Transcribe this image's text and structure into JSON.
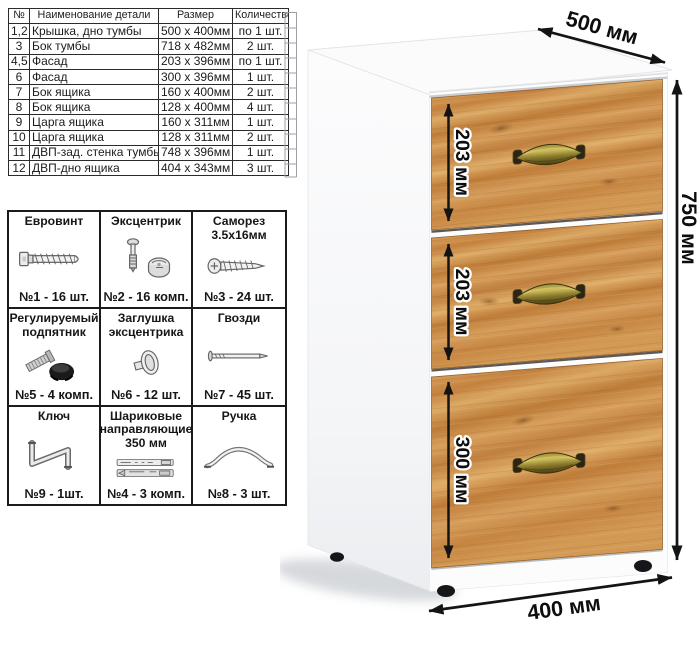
{
  "parts_table": {
    "headers": [
      "№",
      "Наименование детали",
      "Размер",
      "Количество"
    ],
    "rows": [
      {
        "num": "1,2",
        "name": "Крышка, дно тумбы",
        "size": "500 х 400мм",
        "qty": "по 1 шт."
      },
      {
        "num": "3",
        "name": "Бок тумбы",
        "size": "718 х 482мм",
        "qty": "2 шт."
      },
      {
        "num": "4,5",
        "name": "Фасад",
        "size": "203 х 396мм",
        "qty": "по 1 шт."
      },
      {
        "num": "6",
        "name": "Фасад",
        "size": "300 х 396мм",
        "qty": "1 шт."
      },
      {
        "num": "7",
        "name": "Бок ящика",
        "size": "160 х 400мм",
        "qty": "2 шт."
      },
      {
        "num": "8",
        "name": "Бок ящика",
        "size": "128 х 400мм",
        "qty": "4 шт."
      },
      {
        "num": "9",
        "name": "Царга ящика",
        "size": "160 х 311мм",
        "qty": "1 шт."
      },
      {
        "num": "10",
        "name": "Царга ящика",
        "size": "128 х 311мм",
        "qty": "2 шт."
      },
      {
        "num": "11",
        "name": "ДВП-зад. стенка тумбы",
        "size": "748 х 396мм",
        "qty": "1 шт."
      },
      {
        "num": "12",
        "name": "ДВП-дно ящика",
        "size": "404 х 343мм",
        "qty": "3 шт."
      }
    ]
  },
  "hardware": {
    "items": [
      {
        "title": "Евровинт",
        "label": "№1 - 16 шт.",
        "icon": "euro-screw-icon"
      },
      {
        "title": "Эксцентрик",
        "label": "№2 - 16 комп.",
        "icon": "cam-lock-icon"
      },
      {
        "title": "Саморез 3.5х16мм",
        "label": "№3 - 24 шт.",
        "icon": "self-tapping-screw-icon"
      },
      {
        "title": "Регулируемый подпятник",
        "label": "№5 - 4 комп.",
        "icon": "adjustable-foot-icon"
      },
      {
        "title": "Заглушка эксцентрика",
        "label": "№6 - 12 шт.",
        "icon": "cam-cap-icon"
      },
      {
        "title": "Гвозди",
        "label": "№7 - 45 шт.",
        "icon": "nail-icon"
      },
      {
        "title": "Ключ",
        "label": "№9 - 1шт.",
        "icon": "hex-key-icon"
      },
      {
        "title": "Шариковые направляющие 350 мм",
        "label": "№4 - 3 комп.",
        "icon": "ball-bearing-slides-icon"
      },
      {
        "title": "Ручка",
        "label": "№8 - 3 шт.",
        "icon": "drawer-handle-icon"
      }
    ]
  },
  "cabinet": {
    "dimensions": {
      "depth": "500 мм",
      "height": "750 мм",
      "width": "400 мм",
      "drawer1": "203 мм",
      "drawer2": "203 мм",
      "drawer3": "300 мм"
    },
    "colors": {
      "wood": "#c98a49",
      "wood_dark": "#96632e",
      "wood_light": "#e0ae6a",
      "handle_brass": "#8a7a2c",
      "body_white": "#fcfcfd",
      "dimension_line": "#141414"
    }
  }
}
